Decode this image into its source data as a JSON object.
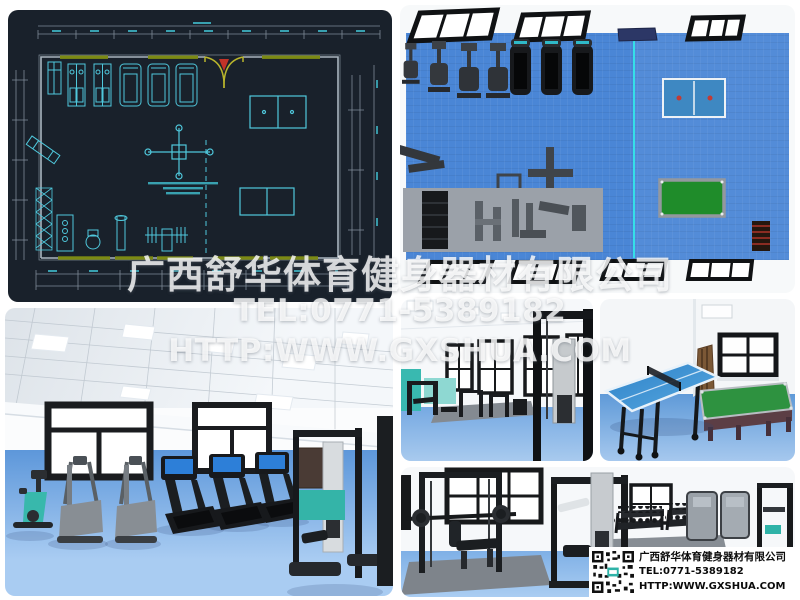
{
  "watermark": {
    "company": "广西舒华体育健身器材有限公司",
    "tel": "TEL:0771-5389182",
    "website": "HTTP:WWW.GXSHUA.COM"
  },
  "info_box": {
    "company": "广西舒华体育健身器材有限公司",
    "tel": "TEL:0771-5389182",
    "website": "HTTP:WWW.GXSHUA.COM",
    "qr_icon": "qr-code-icon",
    "background": "#ffffff",
    "text_color": "#0b0b0b"
  },
  "panels": {
    "floor_plan": {
      "name": "gym-floor-plan-cad",
      "background": "#19212b",
      "equipment_line_color": "#4fc8dc",
      "wall_line_color": "#aab6c0",
      "dimension_line_color": "#7e8b98",
      "dimension_text_color": "#3fb8c8",
      "window_segment_color": "#7c8a14",
      "door_color": "#b9b52c",
      "door_marker_color": "#c23328"
    },
    "top_view": {
      "name": "gym-top-view-render",
      "floor_color": "#4a86d6",
      "divider_line_color": "#35dfe8",
      "mat_color": "#9ba1a9",
      "table_tennis_color": "#3e88c2",
      "billiard_cloth_color": "#1f8c2a",
      "window_frame_color": "#101214"
    },
    "cardio_room": {
      "name": "cardio-room-render",
      "floor_color": "#6ea6e4",
      "bike_accent_color": "#38b8ac",
      "treadmill_screen_color": "#2d7fd8"
    },
    "machines_room": {
      "name": "machines-room-render",
      "wall_mat_color": "#39b9b0"
    },
    "table_tennis_room": {
      "name": "table-tennis-room-render",
      "table_color": "#2e82c8",
      "billiard_cloth_color": "#2e9240"
    },
    "strength_room": {
      "name": "strength-room-render",
      "cabinet_color": "#9aa1a8",
      "accent_color": "#2fb3a8"
    }
  }
}
